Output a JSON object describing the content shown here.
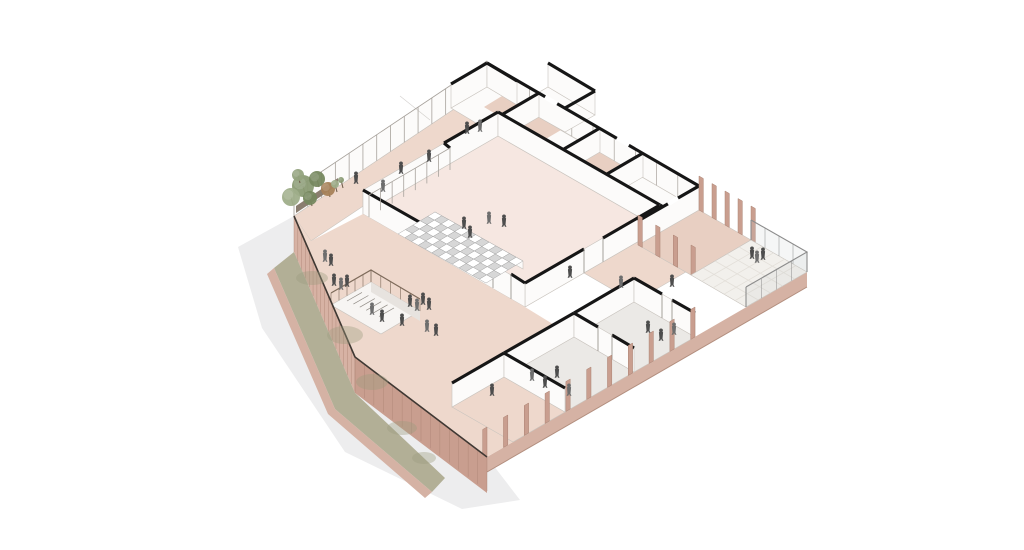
{
  "meta": {
    "title": "Axonometric cutaway drawing of a building level",
    "description": "Sectional axonometric architectural illustration: central hall with tiered seating steps, perimeter corridors, small rooms, open stairwell, east terrace with glass railing, brick perimeter fence with lawn strip, trees and scattered human figures on pink floors, white background with soft drop shadow"
  },
  "colors": {
    "bg": "#ffffff",
    "shadow": "#ededee",
    "floor_pink": "#eed8cc",
    "floor_hall": "#f6e7e1",
    "floor_dark": "#e8cfc2",
    "floor_white": "#fcfbfa",
    "floor_grey": "#ebe9e6",
    "terrace": "#f2f0ec",
    "brick_face": "#d7b2a4",
    "brick_dark": "#c99e8f",
    "brick_band": "#d5b2a4",
    "band_edge": "#b28e7e",
    "brick_joint": "#ab8373",
    "lawn": "#b2af96",
    "lawn_blob": "#9a9b7e",
    "planter": "#8a7d6f",
    "cut": "#161616",
    "line_light": "#c9c4be",
    "line_mid": "#8f8a84",
    "mullion": "#a7a29c",
    "fence_top": "#3f3833",
    "railing": "#8c8c8c",
    "railing_wood": "#7d6a5a",
    "railing_glass": "rgba(190,196,200,0.16)",
    "grid_line": "#e3dfd9",
    "seat_light": "#ffffff",
    "seat_dark": "#d7d7d7",
    "seat_line": "#a0a0a0",
    "people_a": "#4d4d4d",
    "people_b": "#6e6e6e",
    "trunk": "#6e5c4a",
    "tree_palette": [
      "#8a9b74",
      "#76885f",
      "#9fae8a",
      "#a78258",
      "#93a37e"
    ]
  },
  "figures": [
    [
      467,
      134
    ],
    [
      480,
      132
    ],
    [
      429,
      162
    ],
    [
      401,
      174
    ],
    [
      383,
      192
    ],
    [
      356,
      184
    ],
    [
      464,
      229
    ],
    [
      489,
      224
    ],
    [
      504,
      227
    ],
    [
      470,
      238
    ],
    [
      325,
      262
    ],
    [
      331,
      266
    ],
    [
      334,
      286
    ],
    [
      341,
      290
    ],
    [
      347,
      287
    ],
    [
      410,
      307
    ],
    [
      417,
      311
    ],
    [
      423,
      305
    ],
    [
      429,
      310
    ],
    [
      427,
      332
    ],
    [
      436,
      336
    ],
    [
      402,
      326
    ],
    [
      372,
      315
    ],
    [
      382,
      322
    ],
    [
      570,
      278
    ],
    [
      621,
      288
    ],
    [
      672,
      287
    ],
    [
      752,
      259
    ],
    [
      757,
      263
    ],
    [
      763,
      260
    ],
    [
      492,
      396
    ],
    [
      532,
      381
    ],
    [
      545,
      388
    ],
    [
      557,
      378
    ],
    [
      569,
      396
    ],
    [
      648,
      333
    ],
    [
      661,
      341
    ],
    [
      674,
      335
    ]
  ],
  "trees": [
    [
      303,
      186,
      11,
      0
    ],
    [
      317,
      179,
      8,
      1
    ],
    [
      291,
      197,
      9,
      2
    ],
    [
      328,
      189,
      7,
      3
    ],
    [
      310,
      198,
      7,
      1
    ],
    [
      298,
      175,
      6,
      4
    ],
    [
      335,
      184,
      4,
      2
    ],
    [
      341,
      180,
      3,
      0
    ]
  ],
  "lawn_blobs": [
    [
      312,
      278,
      16,
      7
    ],
    [
      345,
      335,
      18,
      9
    ],
    [
      372,
      382,
      16,
      8
    ],
    [
      402,
      428,
      15,
      7
    ],
    [
      424,
      458,
      12,
      6
    ]
  ]
}
